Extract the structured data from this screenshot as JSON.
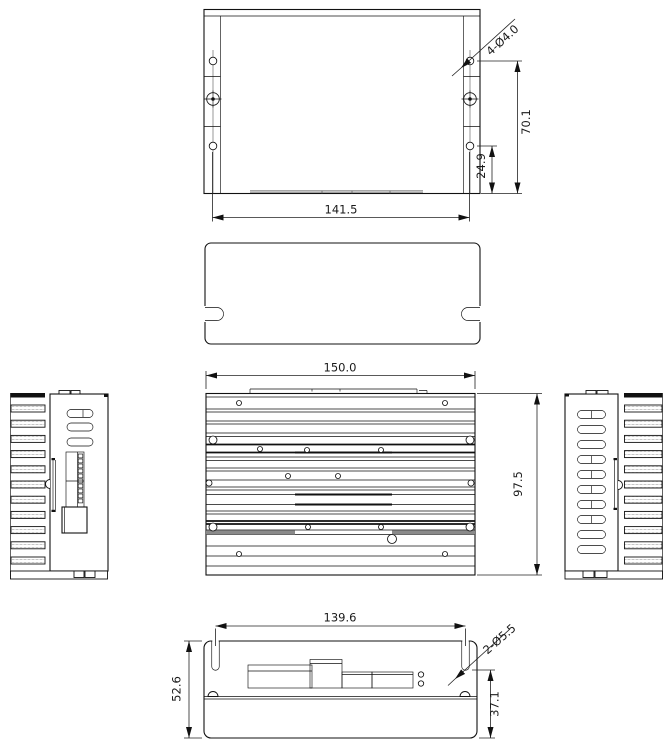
{
  "drawing": {
    "views": {
      "top": {
        "callout": "4-Ø4.0",
        "height": "70.1",
        "hole_offset": "24.9",
        "width": "141.5"
      },
      "front": {
        "width": "150.0",
        "height": "97.5"
      },
      "bottom": {
        "width": "139.6",
        "height": "52.6",
        "slot_height": "37.1",
        "callout": "2-Ø5.5"
      }
    }
  }
}
